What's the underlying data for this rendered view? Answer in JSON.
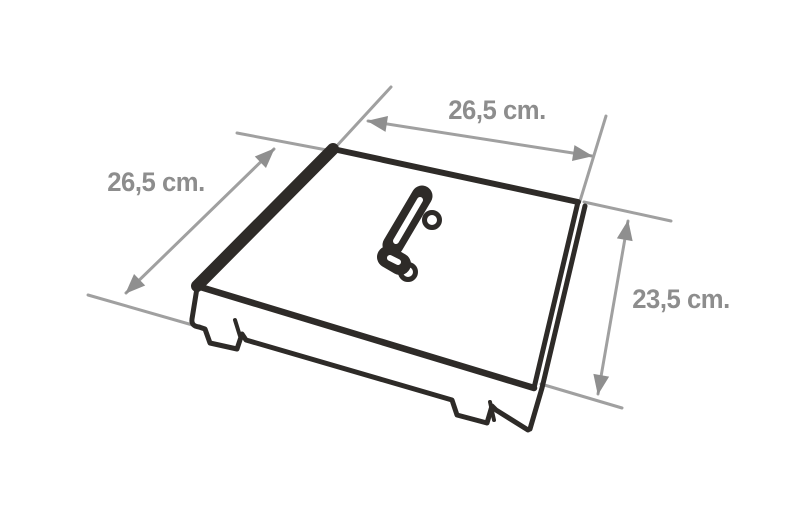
{
  "diagram": {
    "type": "technical-dimension-drawing",
    "subject": "square lid with center handle and rim tabs, isometric view",
    "dimensions": {
      "top": {
        "label": "26,5 cm."
      },
      "left": {
        "label": "26,5 cm."
      },
      "right": {
        "label": "23,5 cm."
      }
    },
    "colors": {
      "outline": "#2e2b28",
      "dimension_line": "#a0a0a0",
      "arrow": "#8f8f8f",
      "label_text": "#8d8d8d",
      "background": "#ffffff"
    }
  }
}
